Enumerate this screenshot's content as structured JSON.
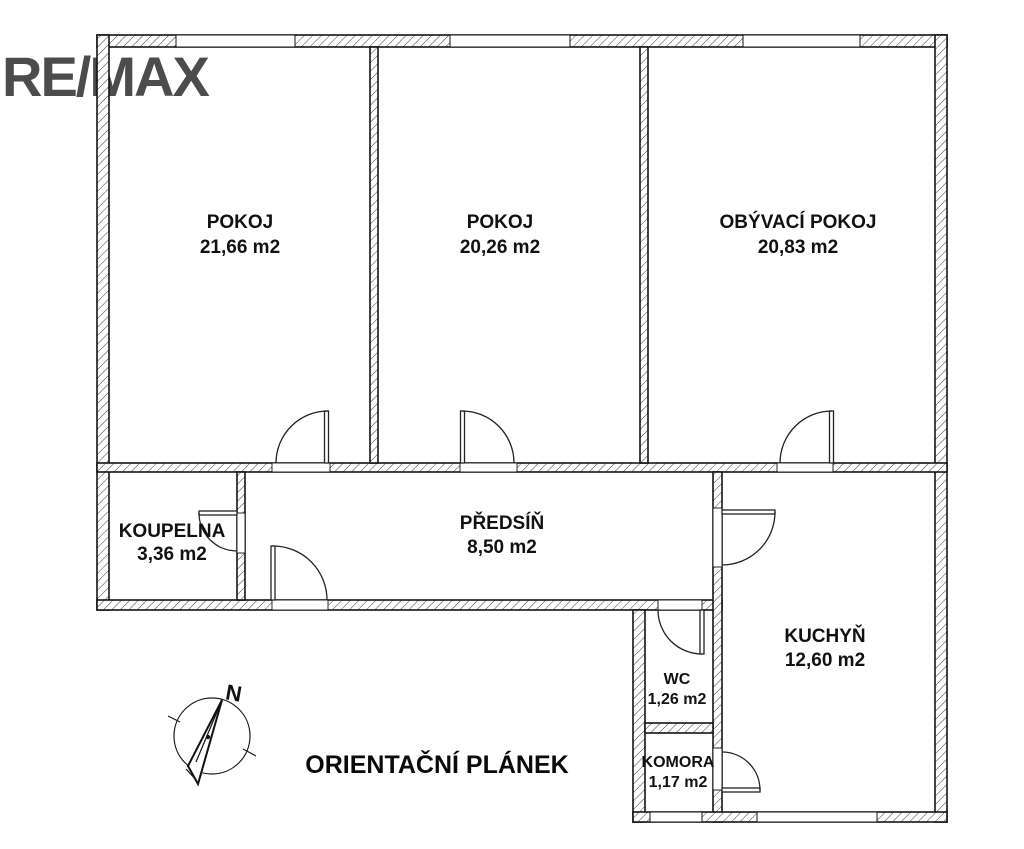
{
  "logo": {
    "text": "RE/MAX"
  },
  "plan_title": "ORIENTAČNÍ PLÁNEK",
  "compass": {
    "north_label": "N"
  },
  "rooms": {
    "pokoj1": {
      "name": "POKOJ",
      "area": "21,66 m2"
    },
    "pokoj2": {
      "name": "POKOJ",
      "area": "20,26 m2"
    },
    "obyvaci_pokoj": {
      "name": "OBÝVACÍ POKOJ",
      "area": "20,83 m2"
    },
    "koupelna": {
      "name": "KOUPELNA",
      "area": "3,36 m2"
    },
    "predsin": {
      "name": "PŘEDSÍŇ",
      "area": "8,50 m2"
    },
    "kuchyn": {
      "name": "KUCHYŇ",
      "area": "12,60 m2"
    },
    "wc": {
      "name": "WC",
      "area": "1,26 m2"
    },
    "komora": {
      "name": "KOMORA",
      "area": "1,17 m2"
    }
  },
  "colors": {
    "background": "#ffffff",
    "wall_outline": "#141414",
    "wall_hatch": "#3d3d3d",
    "door_line": "#222222",
    "label_text": "#111111",
    "logo_text": "#4b4c4e"
  }
}
